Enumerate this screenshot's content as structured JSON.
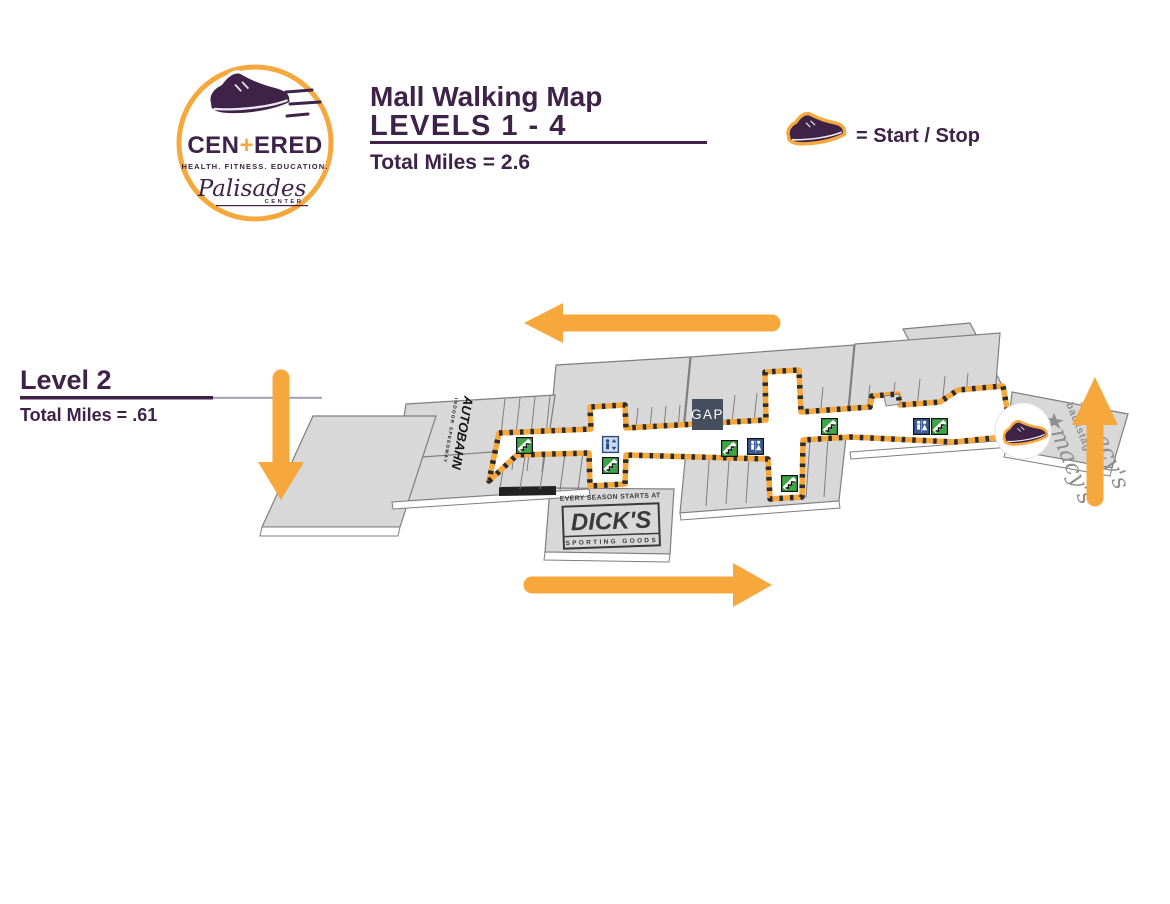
{
  "colors": {
    "purple": "#3F2248",
    "orange": "#F6A83C",
    "map_gray": "#D8D8D8",
    "map_stroke": "#7E7E7E",
    "escalator_green": "#3FA548",
    "restroom_blue": "#3D5C94",
    "gap_navy": "#454E5C",
    "macys_gray": "#8F8F8F",
    "dicks_gray": "#3A3A3A"
  },
  "logo": {
    "brand_pre": "CEN",
    "brand_plus": "+",
    "brand_post": "ERED",
    "tagline": "HEALTH. FITNESS. EDUCATION.",
    "center_name": "Palisades",
    "center_word": "CENTER"
  },
  "header": {
    "title": "Mall Walking Map",
    "subtitle": "LEVELS 1 - 4",
    "total": "Total Miles = 2.6"
  },
  "legend": {
    "label": "= Start / Stop"
  },
  "level": {
    "name": "Level 2",
    "total": "Total Miles = .61"
  },
  "map": {
    "stores": {
      "autobahn": {
        "name": "AUTOBAHN",
        "sub": "INDOOR SPEEDWAY"
      },
      "gap": {
        "name": "GAP"
      },
      "dicks": {
        "tagline": "EVERY SEASON STARTS AT",
        "name": "DICK'S",
        "sub": "SPORTING GOODS"
      },
      "macys": {
        "name": "★macy's",
        "sub": "backstage"
      }
    },
    "route": {
      "marker": "sneaker-start-stop",
      "arrows": [
        "left",
        "down",
        "up",
        "right"
      ]
    },
    "icons": {
      "escalator_count": 6,
      "restroom_count": 2,
      "elevator_count": 1
    }
  }
}
